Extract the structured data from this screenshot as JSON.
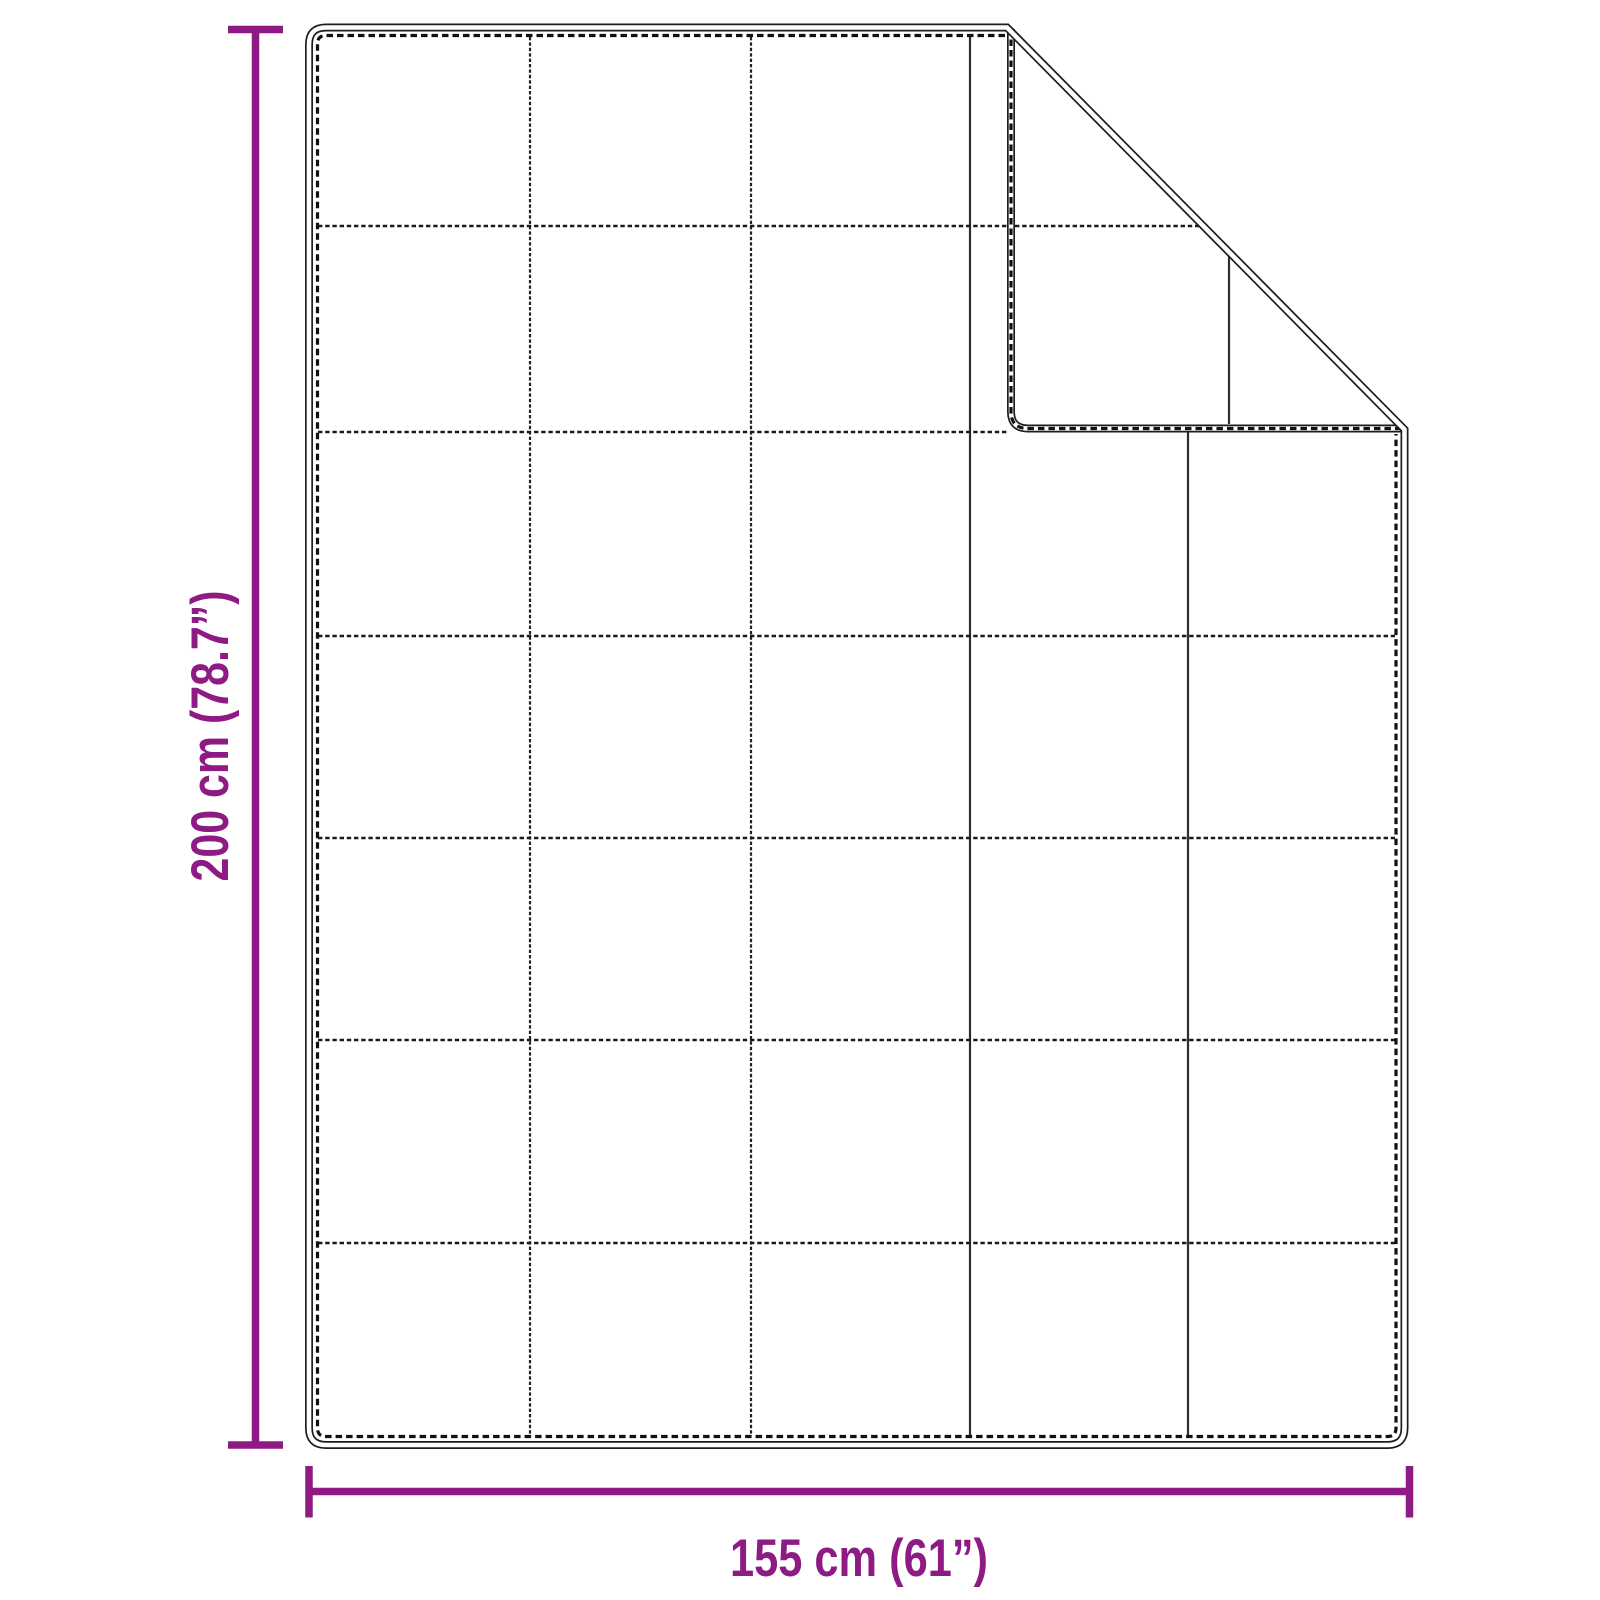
{
  "diagram": {
    "description": "Quilted blanket dimension drawing with folded top-right corner",
    "height_label": "200 cm (78.7”)",
    "width_label": "155 cm (61”)",
    "accent_color": "#8e1b84",
    "outline_color": "#1d1d1d",
    "background_color": "#ffffff",
    "grid_columns": 5,
    "grid_rows": 7
  }
}
